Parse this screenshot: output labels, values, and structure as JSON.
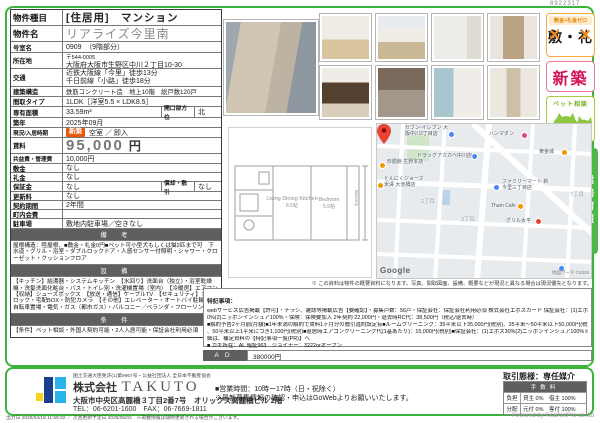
{
  "doc": {
    "id": "8922317",
    "map_note": "※ この資料は物件の概要資料になります。写真、間取図面、設備、概要などが現況と異なる場合は現況優先となります。",
    "footer_left": "出力日 2025/04/18 11:59:32 ／ 次回更新予定日 2025/05/02　※掲載情報は随時更新される場合がございます。",
    "footer_right": "Powered by RealNetPro co.,ltd"
  },
  "colors": {
    "frame_green": "#3cb43c",
    "header_gray": "#5f5f5f",
    "new_row_badge": "#e8590c",
    "shinchiku_red": "#d4145a",
    "pet_green": "#8dc63f",
    "zero_orange": "#f08a1d",
    "gyomu_green": "#4db848"
  },
  "table": {
    "rows": [
      {
        "label": "物件種目",
        "value": "[住居用]　マンション"
      },
      {
        "label": "物件名",
        "value": "リアライズ今里南"
      },
      {
        "label": "号室名",
        "value": "0909　（9階部分）"
      },
      {
        "label": "所在地",
        "line1": "〒544-0005",
        "line2": "大阪府大阪市生野区中川２丁目10-30"
      },
      {
        "label": "交通",
        "line1": "近鉄大阪線「今里」徒歩13分",
        "line2": "千日前線「小路」徒歩18分"
      },
      {
        "label": "建築構造",
        "value": "鉄筋コンクリート造　地上10階　総戸数120戸"
      },
      {
        "label": "間取タイプ",
        "value": "1LDK［洋室5.5 × LDK8.5］"
      },
      {
        "label": "専有面積",
        "value": "33.59m²",
        "label2": "開口部方位",
        "value2": "北"
      },
      {
        "label": "築年",
        "value": "2025年09月"
      },
      {
        "label": "現況/入居時期",
        "badge": "新築",
        "value": "空室 ／ 即入"
      },
      {
        "label": "賃料",
        "value": "95,000",
        "unit": "円"
      },
      {
        "label": "共益費・管理費",
        "value": "10,000円"
      },
      {
        "label": "敷金",
        "value": "なし"
      },
      {
        "label": "礼金",
        "value": "なし"
      },
      {
        "label": "保証金",
        "value": "なし",
        "label2": "償却・敷引",
        "value2": "なし"
      },
      {
        "label": "更新料",
        "value": "なし"
      },
      {
        "label": "契約期間",
        "value": "2年間"
      },
      {
        "label": "町内会費",
        "value": ""
      },
      {
        "label": "駐車場",
        "value": "敷地内駐車場／空きなし"
      }
    ]
  },
  "sections": {
    "remarks_title": "備　考",
    "remarks": "屋根構造：陸屋根、■敷金・礼金0円■ペット可小型犬もしくは猫2匹まで可　下水道・グリル・浴室・ダブルロックドア・人感センサー付照明・シャワー・クローゼット・クッションフロア",
    "equipment_title": "設　備",
    "equipment": "【キッチン】給湯器・システムキッチン　【水回り】洗面台（独立）・浴室乾燥機・洗髪洗面化粧台・バス・トイレ別・洗濯機置場（室内）　【冷暖房】エアコン　【収納】シューズボックス　【放送・通信】ケーブルTV　【セキュリティ】オートロック・宅配BOX・防犯カメラ　【その他】エレベーター・オートバイ駐輪場・自転車置場・電気・ガス（都市ガス）・バルコニー／ベランダ・フローリング",
    "conditions_title": "条　件",
    "conditions": "【条件】ペット相談・外国人契約可能・2人入居可能・保証会社利用必須"
  },
  "badges": {
    "zero_top": "敷金+礼金ゼロ",
    "zero_left": "敷",
    "zero_sep": "・",
    "zero_right": "礼",
    "zero_cross": "×",
    "shinchiku": "新築",
    "pet": "ペット相談"
  },
  "photos": [
    "exterior-building",
    "living-room",
    "living-room-window",
    "closet",
    "hallway",
    "kitchen",
    "bathroom",
    "toilet",
    "washroom"
  ],
  "floor_plan": {
    "ldk_label": "Living Dining Kitchen",
    "ldk_size": "8.5帖",
    "bedroom_label": "Bedroom",
    "bedroom_size": "5.5帖",
    "balcony_label": "Balcony"
  },
  "map": {
    "pois": [
      {
        "label": "セブン-イレブン 大阪中川3丁目店"
      },
      {
        "label": "ハンマダン"
      },
      {
        "label": "ドラッグアカカベ中川店"
      },
      {
        "label": "黄金城"
      },
      {
        "label": "珍膳館 生野本店"
      },
      {
        "label": "とんにくジョーズ 米澤 大池橋店"
      },
      {
        "label": "ファミリーマート 新今里三丁目店"
      },
      {
        "label": "Tham Cafe"
      },
      {
        "label": "グリル太平"
      }
    ],
    "districts": [
      "2丁目",
      "3丁目",
      "7丁目"
    ],
    "google": "Google",
    "attribution": "地図データ ©2025"
  },
  "tokki": {
    "title": "特記事項：",
    "lines": [
      "webサービス広告掲載【許可】・チラシ、雑誌等掲載広告【要確認】・募集戸数：56戸・保証会社：保証会社利用必須 株式会社エポスカード 保証会社：(1)エポス3",
      "0%(2)ニッポンインシュア100%・保険：保険要加入 2年契約 22,000円・退去時RC代：38,500円（税込/退去時）",
      "■解約予告2ヶ月前(月額)■1年未満の解約で賃料1ヶ月分の敷引違約設定有■ルームクリーニング：35平米以下35,000円(税別)、35平米〜50平米以下50,000円(税別)",
      "、50平米以上1平米につき1,100円(税別)■退居時エアコンクリーニング代(1基あたり)：15,000円(税別)■保証会社：(1)エポス30%(2)ニッポンインシュア100%※詳",
      "細は、補足資料の【特記事項一覧(PR)】へ",
      "■ カギ所在：AL 暗証963　ジョイナー：3222orオープン"
    ]
  },
  "ad": {
    "label": "AD",
    "value": "380000円"
  },
  "gyomu_tab": "業務情報",
  "company": {
    "license": "国土交通大臣免許(1)第9967号・公益社団法人 全日本不動産協会",
    "name_prefix": "株式会社",
    "name": "TAKUTO",
    "address": "大阪市中央区高麗橋３丁目2番7号　オリックス高麗橋ビル 2階",
    "tel_fax": "TEL：06-6201-1600　FAX：06-7669-1811"
  },
  "business": {
    "hours": "■営業時間：10時ー17時（日・祝除く）",
    "note": "※最新募集情報の確認・申込はGoWebよりお願いいたします。",
    "dealing": "取引態様：専任媒介",
    "fee_header": "手数料",
    "fee_rows": [
      {
        "k": "負担",
        "v": "貸主 0%　借主 100%"
      },
      {
        "k": "分配",
        "v": "元付 0%　客付 100%"
      }
    ]
  }
}
